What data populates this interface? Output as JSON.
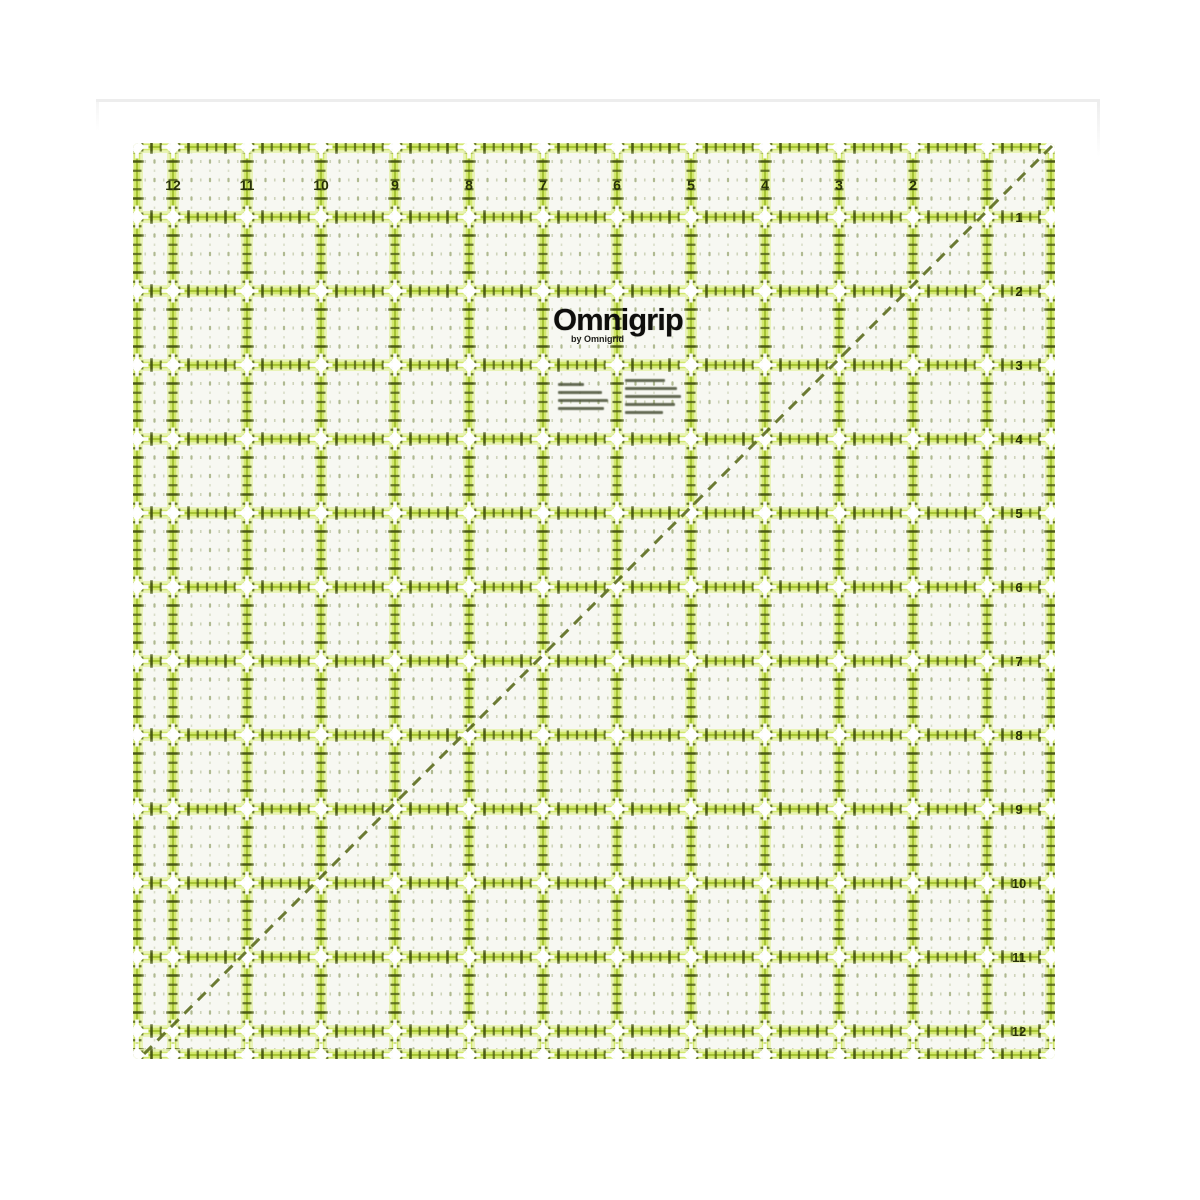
{
  "product": {
    "brand": "Omnigrip",
    "byline": "by Omnigrid"
  },
  "ruler": {
    "top_labels": [
      "12",
      "11",
      "10",
      "9",
      "8",
      "7",
      "6",
      "5",
      "4",
      "3",
      "2"
    ],
    "right_labels": [
      "1",
      "2",
      "3",
      "4",
      "5",
      "6",
      "7",
      "8",
      "9",
      "10",
      "11",
      "12"
    ],
    "colors": {
      "glow_outer": "#e6f2ad",
      "glow_inner": "#cfe765",
      "line_center": "#a3c232",
      "tick_dark": "#4d5d16",
      "half_tick_dark": "#445312",
      "cell_dot": "#7e8f4e",
      "cell_dot_pale": "#b9c19e",
      "digit_ink": "#28310a",
      "diagonal": "#5b6c1e",
      "ruler_bg": "#f7f8f2",
      "star_white": "#ffffff"
    },
    "fine_print": {
      "note": "two blocks of illegible product-information fine print",
      "left_line_widths": [
        26,
        44,
        50,
        46
      ],
      "right_line_widths": [
        40,
        52,
        56,
        50,
        38
      ]
    }
  }
}
